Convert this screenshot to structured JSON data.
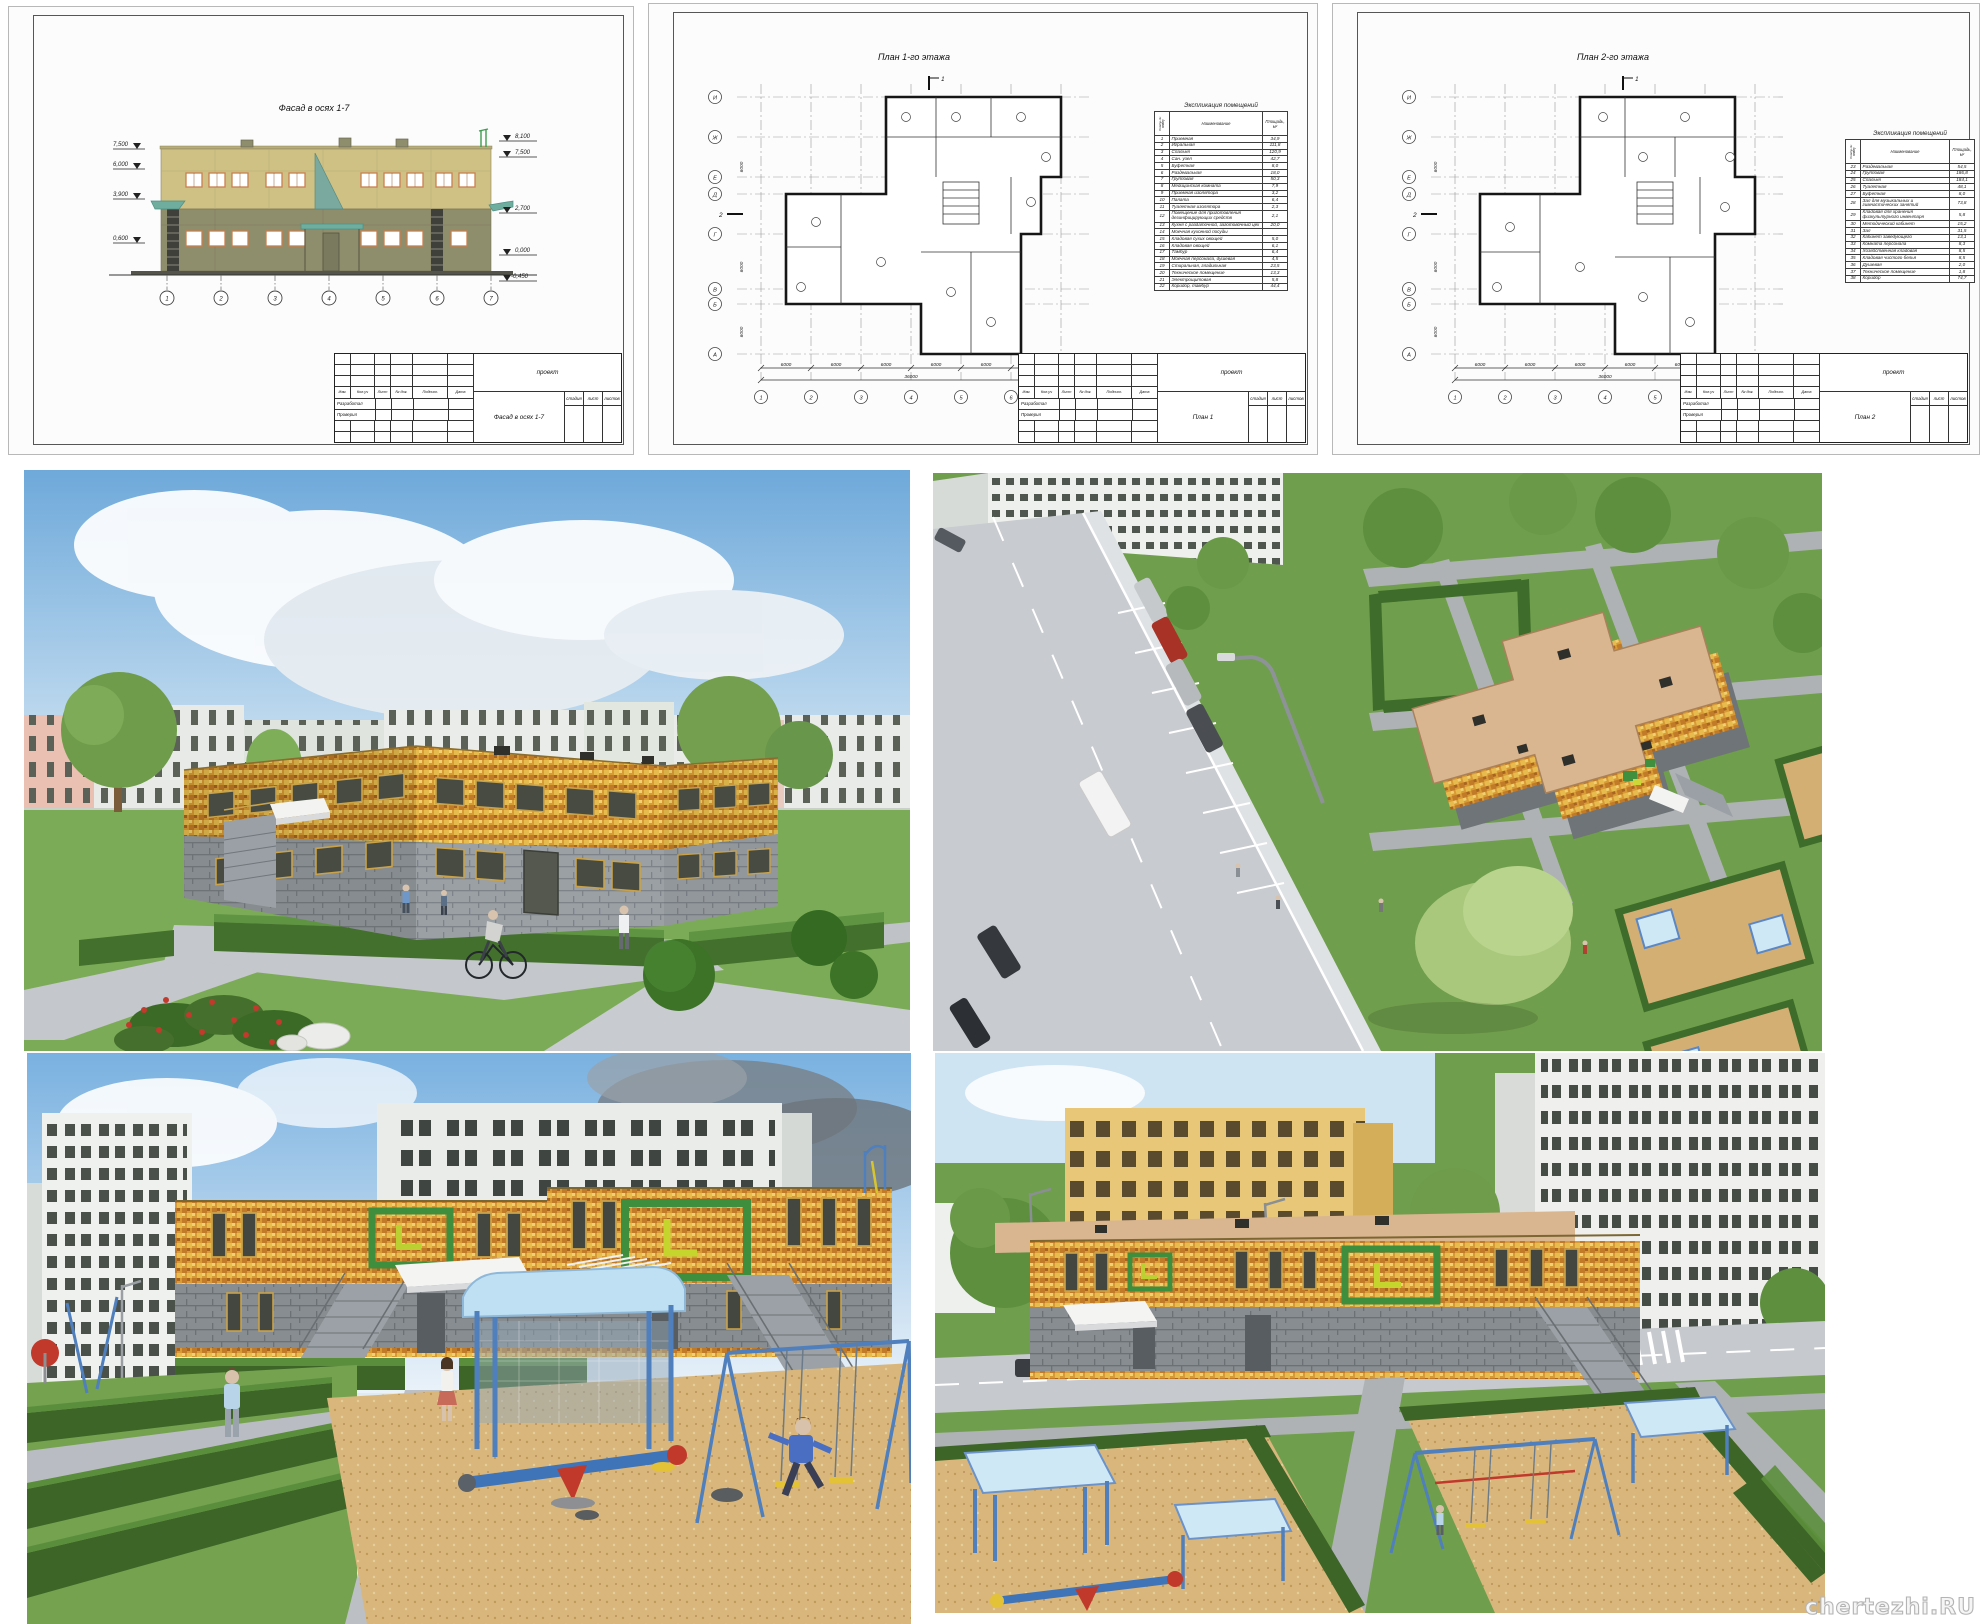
{
  "watermark": "chertezhi.RU",
  "colors": {
    "facade_upper": "#cfc183",
    "facade_lower": "#8e8d6c",
    "window_frame": "#c97f4f",
    "mosaic_yellow": "#d89a35",
    "lower_block_gray": "#9aa0a4",
    "hedge_green": "#3c6527",
    "lawn_green": "#74a24f",
    "sand": "#d9b77c",
    "path_gray": "#c3c6ca",
    "roof_tan": "#d9b690",
    "canopy_blue": "#bfe0f2",
    "decor_green": "#3e8e3e",
    "decor_yellow": "#bcd032"
  },
  "title_block": {
    "project": "проект",
    "cols": [
      "Изм.",
      "Кол.уч",
      "Лист",
      "№ док.",
      "Подпись",
      "Дата"
    ],
    "developed": "Разработал",
    "checked": "Проверил",
    "stage": "стадия",
    "sheet": "лист",
    "sheets_total": "листов"
  },
  "facade_sheet": {
    "title": "Фасад в осях 1-7",
    "doc_title": "Фасад в осях 1-7",
    "marks_left": [
      "7,500",
      "6,000",
      "3,900",
      "0,600"
    ],
    "marks_right": [
      "8,100",
      "7,500",
      "2,700",
      "0,000",
      "-0,450"
    ],
    "axes": [
      "1",
      "2",
      "3",
      "4",
      "5",
      "6",
      "7"
    ]
  },
  "plan1_sheet": {
    "title": "План 1-го этажа",
    "doc_title": "План 1",
    "table_title": "Экспликация помещений",
    "col_num": "Номер по плану",
    "col_name": "Наименование",
    "col_area": "Площадь, м²",
    "rooms": [
      [
        "1",
        "Приемная",
        "34,9"
      ],
      [
        "2",
        "Игральная",
        "111,8"
      ],
      [
        "3",
        "Спальня",
        "120,9"
      ],
      [
        "4",
        "Сан. узел",
        "42,7"
      ],
      [
        "5",
        "Буфетная",
        "8,0"
      ],
      [
        "6",
        "Раздевальная",
        "18,0"
      ],
      [
        "7",
        "Групповая",
        "50,3"
      ],
      [
        "8",
        "Медицинская комната",
        "7,9"
      ],
      [
        "9",
        "Приемная изолятора",
        "3,2"
      ],
      [
        "10",
        "Палата",
        "6,4"
      ],
      [
        "11",
        "Туалетная изолятора",
        "2,3"
      ],
      [
        "12",
        "Помещение для приготовления дезинфицирующих средств",
        "2,1"
      ],
      [
        "13",
        "Кухня с раздаточной, заготовочный цех",
        "20,0"
      ],
      [
        "14",
        "Моечная кухонной посуды",
        ""
      ],
      [
        "15",
        "Кладовая сухих овощей",
        "5,0"
      ],
      [
        "16",
        "Кладовая овощей",
        "6,1"
      ],
      [
        "17",
        "Тамбур",
        "6,4"
      ],
      [
        "18",
        "Моечная персонала, душевая",
        "4,5"
      ],
      [
        "19",
        "Стиральная, гладильная",
        "23,5"
      ],
      [
        "20",
        "Техническое помещение",
        "13,3"
      ],
      [
        "21",
        "Электрощитовая",
        "5,8"
      ],
      [
        "22",
        "Коридор, тамбур",
        "44,4"
      ]
    ],
    "axes": [
      "1",
      "2",
      "3",
      "4",
      "5",
      "6",
      "7"
    ],
    "axes_v": [
      "И",
      "Ж",
      "Е",
      "Д",
      "Г",
      "В",
      "Б",
      "А"
    ],
    "dim": "6000",
    "dim_total": "36000",
    "dim_side": "6000",
    "sections": [
      "1",
      "2"
    ]
  },
  "plan2_sheet": {
    "title": "План 2-го этажа",
    "doc_title": "План 2",
    "table_title": "Экспликация помещений",
    "col_num": "Номер по плану",
    "col_name": "Наименование",
    "col_area": "Площадь, м²",
    "rooms": [
      [
        "23",
        "Раздевальная",
        "54,5"
      ],
      [
        "24",
        "Групповая",
        "186,8"
      ],
      [
        "25",
        "Спальня",
        "184,1"
      ],
      [
        "26",
        "Туалетная",
        "48,1"
      ],
      [
        "27",
        "Буфетная",
        "8,0"
      ],
      [
        "28",
        "Зал для музыкальных и гимнастических занятий",
        "73,8"
      ],
      [
        "29",
        "Кладовая для хранения физкультурного инвентаря",
        "5,8"
      ],
      [
        "30",
        "Методический кабинет",
        "15,2"
      ],
      [
        "31",
        "Зал",
        "31,5"
      ],
      [
        "32",
        "Кабинет заведующего",
        "13,1"
      ],
      [
        "33",
        "Комната персонала",
        "8,3"
      ],
      [
        "34",
        "Хозяйственная кладовая",
        "8,5"
      ],
      [
        "35",
        "Кладовая чистого белья",
        "8,5"
      ],
      [
        "36",
        "Душевая",
        "2,0"
      ],
      [
        "37",
        "Техническое помещение",
        "1,8"
      ],
      [
        "38",
        "Коридор",
        "74,7"
      ]
    ],
    "axes": [
      "1",
      "2",
      "3",
      "4",
      "5",
      "6",
      "7"
    ],
    "axes_v": [
      "И",
      "Ж",
      "Е",
      "Д",
      "Г",
      "В",
      "Б",
      "А"
    ],
    "dim": "6000",
    "dim_total": "36000",
    "dim_side": "6000",
    "sections": [
      "1",
      "2"
    ]
  }
}
